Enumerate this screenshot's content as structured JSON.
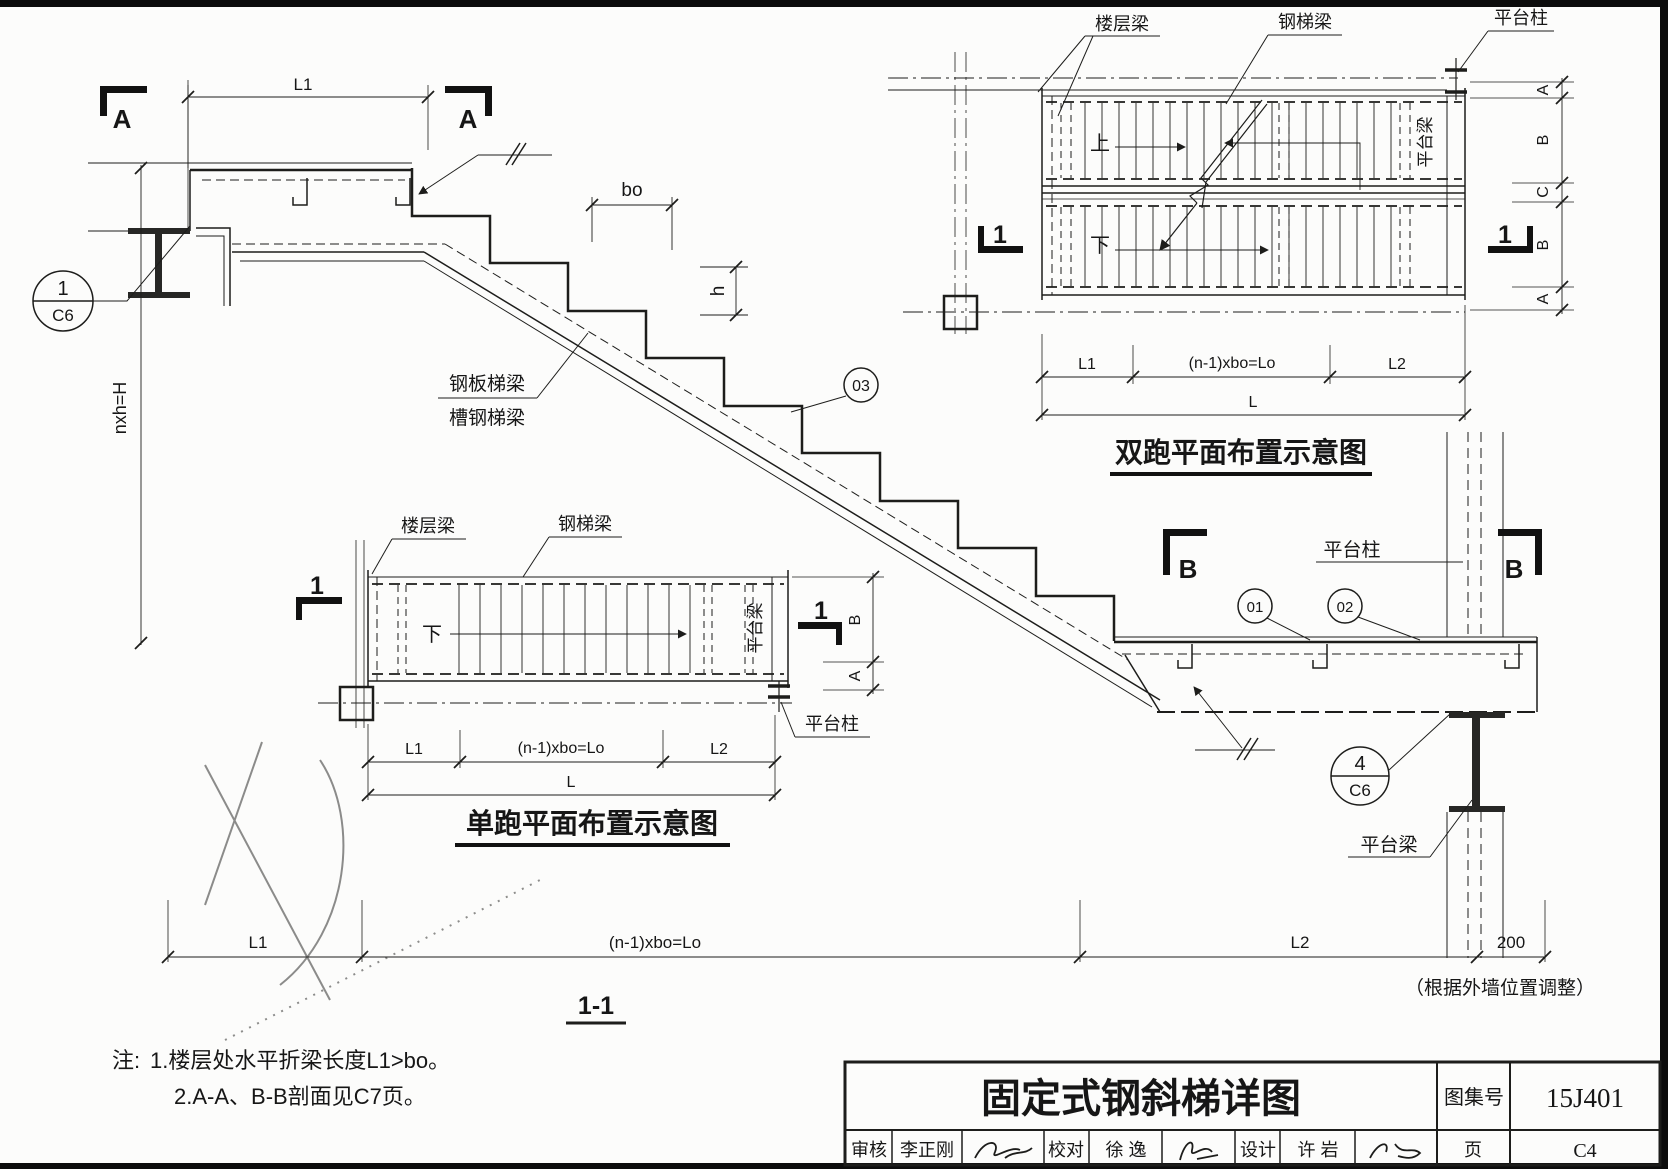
{
  "section_view": {
    "name": "1-1",
    "marks": {
      "a": "A",
      "b": "B"
    },
    "labels": {
      "steel_plate_stringer": "钢板梯梁",
      "channel_stringer": "槽钢梯梁",
      "platform_column": "平台柱",
      "platform_beam": "平台梁",
      "height_formula": "nxh=H",
      "tread": "bo",
      "riser": "h"
    },
    "refs": {
      "r01": "01",
      "r02": "02",
      "r03": "03",
      "d1_num": "1",
      "d1_page": "C6",
      "d4_num": "4",
      "d4_page": "C6"
    },
    "dims": {
      "l1": "L1",
      "run": "(n-1)xbo=Lo",
      "l2": "L2",
      "wall_offset": "200",
      "wall_note": "（根据外墙位置调整）"
    }
  },
  "plan_double": {
    "title": "双跑平面布置示意图",
    "mark": "1",
    "labels": {
      "floor_beam": "楼层梁",
      "stair_beam": "钢梯梁",
      "platform_column": "平台柱",
      "platform_beam": "平台梁",
      "up": "上",
      "down": "下"
    },
    "dims": {
      "l1": "L1",
      "run": "(n-1)xbo=Lo",
      "l2": "L2",
      "total": "L",
      "side": [
        "A",
        "B",
        "C",
        "B",
        "A"
      ]
    }
  },
  "plan_single": {
    "title": "单跑平面布置示意图",
    "mark": "1",
    "labels": {
      "floor_beam": "楼层梁",
      "stair_beam": "钢梯梁",
      "platform_column": "平台柱",
      "platform_beam": "平台梁",
      "down": "下"
    },
    "dims": {
      "l1": "L1",
      "run": "(n-1)xbo=Lo",
      "l2": "L2",
      "total": "L",
      "side_b": "B",
      "side_a": "A"
    }
  },
  "notes": {
    "prefix": "注:",
    "line1": "1.楼层处水平折梁长度L1>bo。",
    "line2": "2.A-A、B-B剖面见C7页。"
  },
  "title_block": {
    "title": "固定式钢斜梯详图",
    "atlas_label": "图集号",
    "atlas_no": "15J401",
    "page_label": "页",
    "page_no": "C4",
    "review_label": "审核",
    "reviewer": "李正刚",
    "check_label": "校对",
    "checker": "徐 逸",
    "design_label": "设计",
    "designer": "许 岩"
  }
}
